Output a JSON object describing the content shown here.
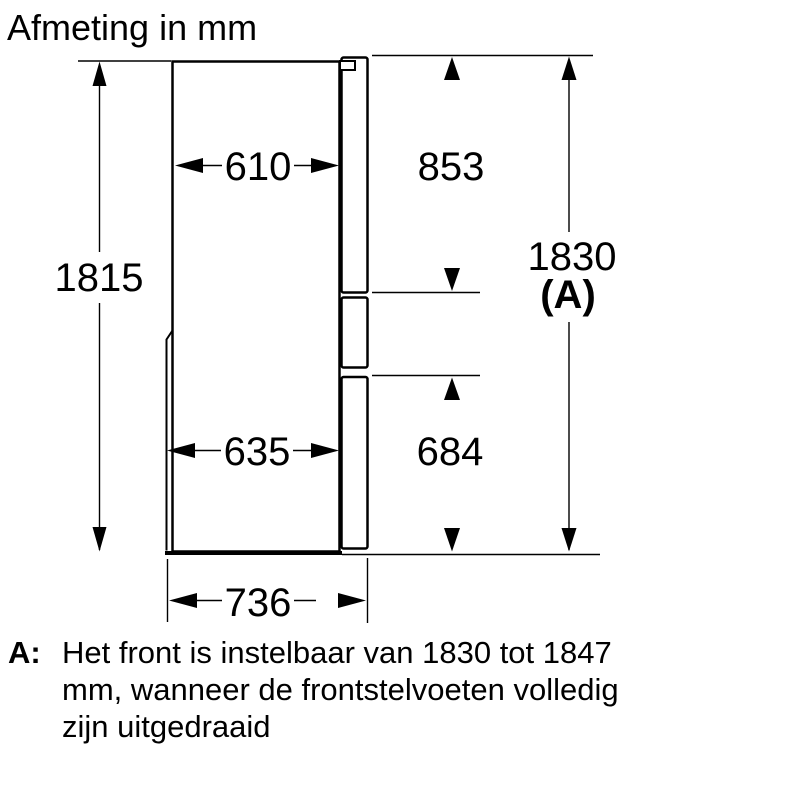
{
  "title": "Afmeting in mm",
  "dimensions": {
    "body_depth_top": "610",
    "upper_door_height": "853",
    "body_height": "1815",
    "overall_height": "1830",
    "overall_height_ref": "(A)",
    "body_depth_bottom": "635",
    "lower_door_height": "684",
    "overall_depth": "736"
  },
  "note": {
    "prefix": "A:",
    "lines": [
      "Het front is instelbaar van 1830 tot 1847",
      "mm, wanneer de frontstelvoeten volledig",
      "zijn uitgedraaid"
    ]
  },
  "colors": {
    "line": "#000000",
    "background": "#ffffff"
  }
}
